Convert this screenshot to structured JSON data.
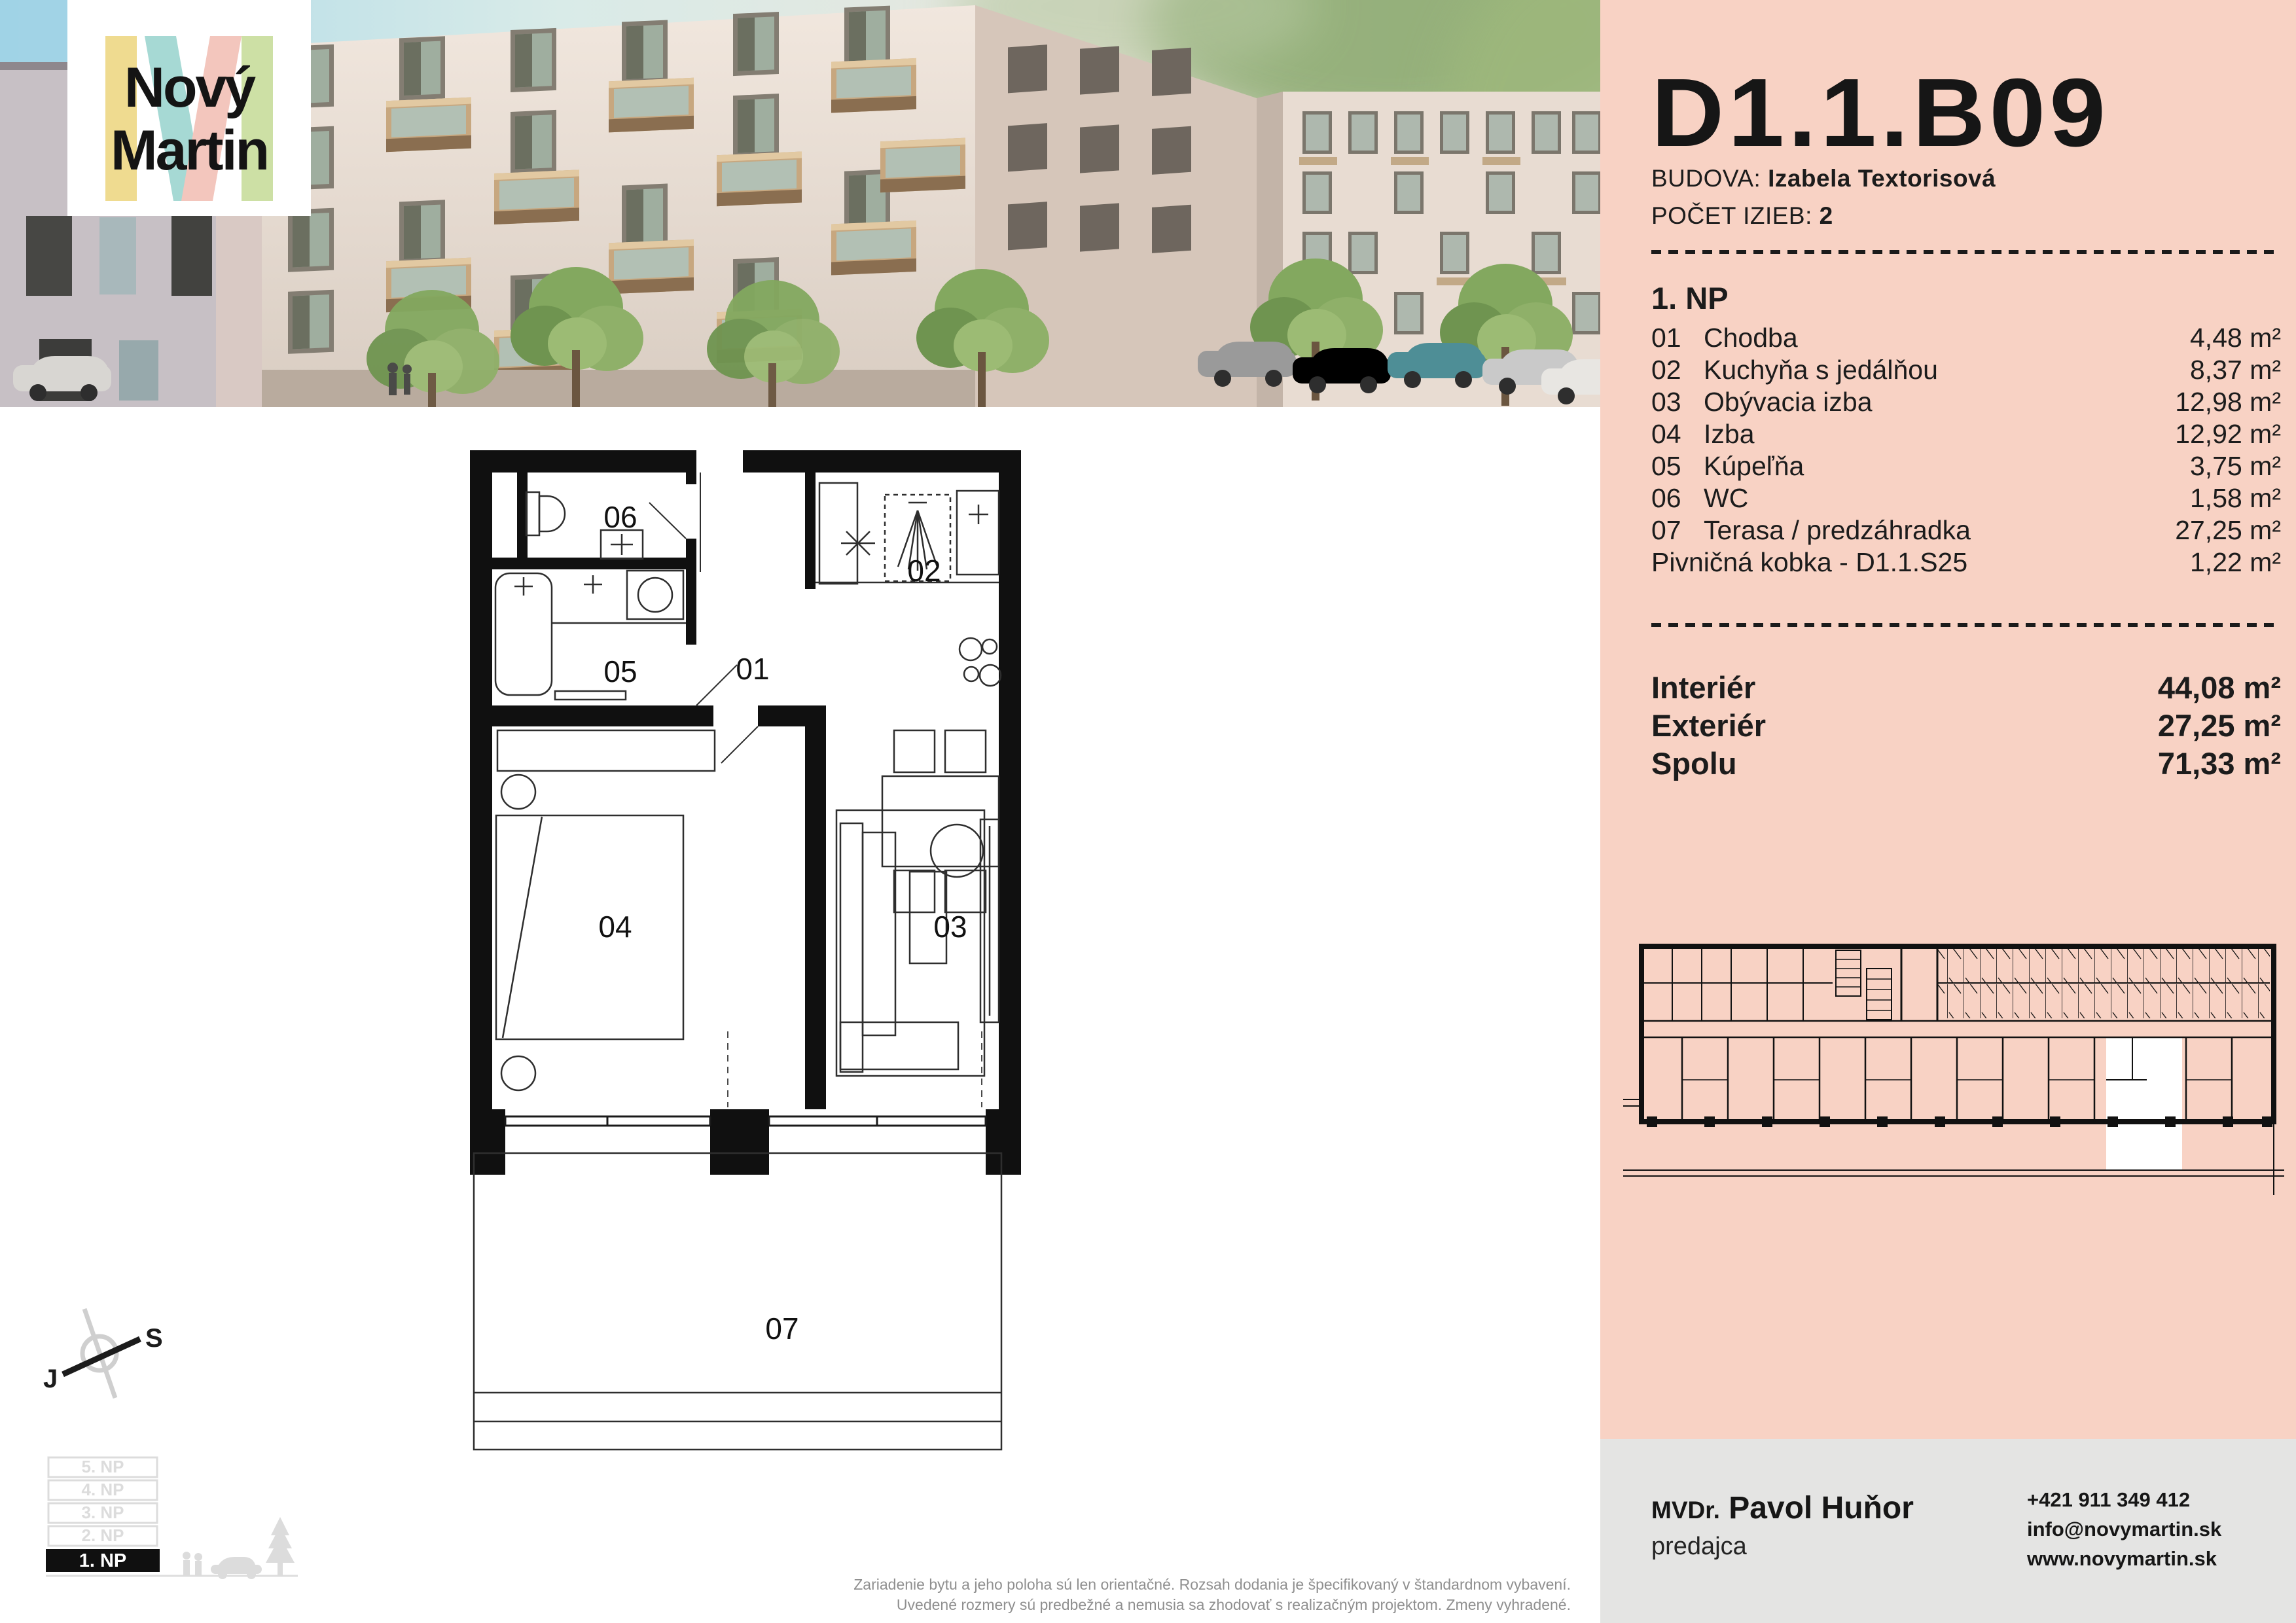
{
  "logo": {
    "line1": "Nový",
    "line2": "Martin"
  },
  "header": {
    "unit_code": "D1.1.B09",
    "building_label": "BUDOVA:",
    "building_name": "Izabela Textorisová",
    "rooms_label": "POČET IZIEB:",
    "rooms_value": "2",
    "floor_heading": "1. NP"
  },
  "rooms": [
    {
      "num": "01",
      "name": "Chodba",
      "area": "4,48 m²"
    },
    {
      "num": "02",
      "name": "Kuchyňa s jedálňou",
      "area": "8,37 m²"
    },
    {
      "num": "03",
      "name": "Obývacia izba",
      "area": "12,98 m²"
    },
    {
      "num": "04",
      "name": "Izba",
      "area": "12,92 m²"
    },
    {
      "num": "05",
      "name": "Kúpeľňa",
      "area": "3,75 m²"
    },
    {
      "num": "06",
      "name": "WC",
      "area": "1,58 m²"
    },
    {
      "num": "07",
      "name": "Terasa / predzáhradka",
      "area": "27,25 m²"
    },
    {
      "num": "",
      "name": "Pivničná kobka - D1.1.S25",
      "area": "1,22 m²"
    }
  ],
  "totals": [
    {
      "label": "Interiér",
      "value": "44,08 m²"
    },
    {
      "label": "Exteriér",
      "value": "27,25 m²"
    },
    {
      "label": "Spolu",
      "value": "71,33 m²"
    }
  ],
  "compass": {
    "south_label": "J",
    "north_label": "S"
  },
  "floor_selector": [
    "5. NP",
    "4. NP",
    "3. NP",
    "2. NP",
    "1. NP"
  ],
  "contact": {
    "title": "MVDr.",
    "name": "Pavol Huňor",
    "role": "predajca",
    "phone": "+421 911 349 412",
    "email": "info@novymartin.sk",
    "web": "www.novymartin.sk"
  },
  "disclaimer": {
    "line1": "Zariadenie bytu a jeho poloha sú len orientačné. Rozsah dodania je špecifikovaný v štandardnom vybavení.",
    "line2": "Uvedené rozmery sú predbežné a nemusia sa zhodovať s realizačným projektom. Zmeny vyhradené."
  },
  "colors": {
    "panel_pink": "#f8d2c4",
    "footer_gray": "#e4e4e3",
    "logo_yellow": "#efdb90",
    "logo_teal": "#a6d9d4",
    "logo_pink": "#f3c6bd",
    "logo_green": "#cde0a5",
    "text_dark": "#1c1c1c",
    "highlight_unit": "#ffffff"
  }
}
